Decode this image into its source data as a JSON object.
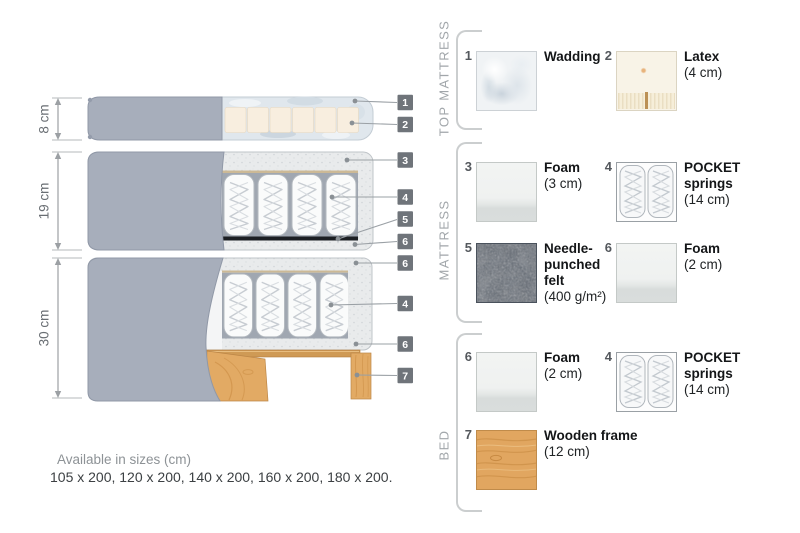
{
  "diagram": {
    "dims": [
      "8 cm",
      "19 cm",
      "30 cm"
    ],
    "callouts": [
      "1",
      "2",
      "3",
      "4",
      "5",
      "6",
      "6",
      "4",
      "6",
      "7"
    ]
  },
  "legend": {
    "sections": [
      {
        "title": "TOP MATTRESS",
        "items": [
          {
            "num": "1",
            "name": "Wadding",
            "detail": ""
          },
          {
            "num": "2",
            "name": "Latex",
            "detail": "(4 cm)"
          }
        ]
      },
      {
        "title": "MATTRESS",
        "items": [
          {
            "num": "3",
            "name": "Foam",
            "detail": "(3 cm)"
          },
          {
            "num": "4",
            "name": "POCKET\nsprings",
            "detail": "(14 cm)"
          },
          {
            "num": "5",
            "name": "Needle-\npunched\nfelt",
            "detail": "(400 g/m²)"
          },
          {
            "num": "6",
            "name": "Foam",
            "detail": "(2 cm)"
          }
        ]
      },
      {
        "title": "BED",
        "items": [
          {
            "num": "6",
            "name": "Foam",
            "detail": "(2 cm)"
          },
          {
            "num": "4",
            "name": "POCKET\nsprings",
            "detail": "(14 cm)"
          },
          {
            "num": "7",
            "name": "Wooden frame",
            "detail": "(12 cm)"
          }
        ]
      }
    ]
  },
  "footer": {
    "sizes_label": "Available in sizes (cm)",
    "sizes_values": "105 x 200, 120 x 200, 140 x 200, 160 x 200, 180 x 200."
  },
  "colors": {
    "cover_gray": "#a7aebb",
    "wadding_blue": "#e0e7ed",
    "latex_cream": "#f8eedf",
    "felt_dark": "#5a626d",
    "wood": "#e2aa64",
    "callout_label_bg": "#6f747a"
  }
}
